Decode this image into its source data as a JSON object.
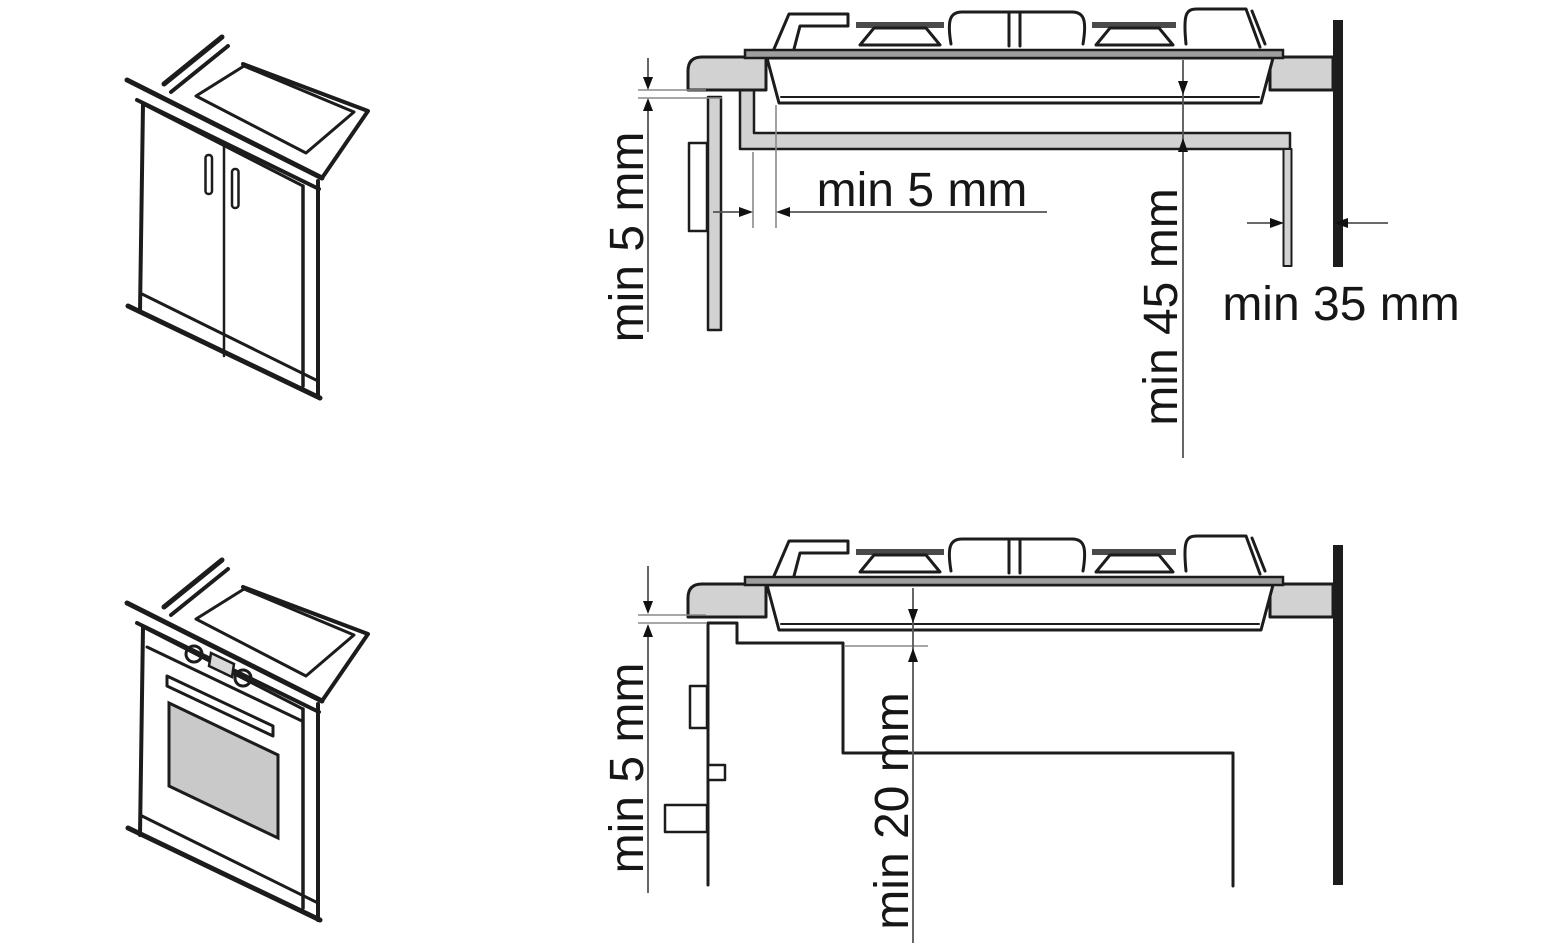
{
  "colors": {
    "line": "#1c1c1c",
    "panel_gray": "#d2d2d2",
    "wall_black": "#1c1c1c",
    "burner_cap_dark": "#4a4a4a",
    "hob_plate_gray": "#9e9e9e"
  },
  "top_diagram": {
    "labels": {
      "vertical_gap": "min 5 mm",
      "horizontal_gap": "min 5 mm",
      "below_clearance": "min 45 mm",
      "wall_gap": "min 35 mm"
    }
  },
  "bottom_diagram": {
    "labels": {
      "vertical_gap": "min 5 mm",
      "oven_clearance": "min 20 mm"
    }
  }
}
